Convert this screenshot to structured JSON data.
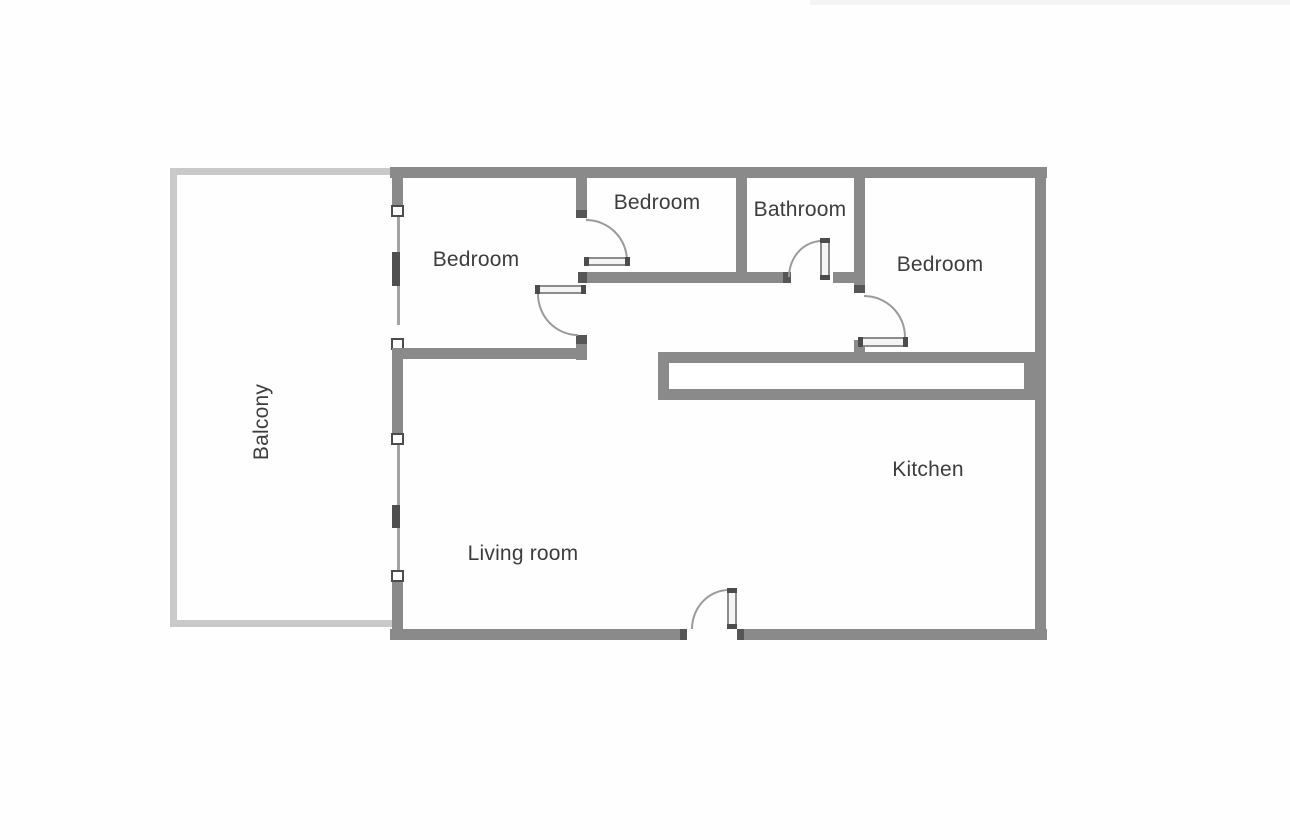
{
  "floorplan": {
    "rooms": [
      {
        "id": "balcony",
        "label": "Balcony"
      },
      {
        "id": "bedroom-left",
        "label": "Bedroom"
      },
      {
        "id": "bedroom-middle",
        "label": "Bedroom"
      },
      {
        "id": "bathroom",
        "label": "Bathroom"
      },
      {
        "id": "bedroom-right",
        "label": "Bedroom"
      },
      {
        "id": "kitchen",
        "label": "Kitchen"
      },
      {
        "id": "living-room",
        "label": "Living room"
      }
    ],
    "colors": {
      "wall": "#8a8a8a",
      "balcony_wall": "#c9c9c9",
      "door_swing_arc": "#9a9a9a",
      "door_jamb": "#4c4c4c",
      "label_text": "#3d3d3d",
      "background": "#ffffff"
    }
  }
}
